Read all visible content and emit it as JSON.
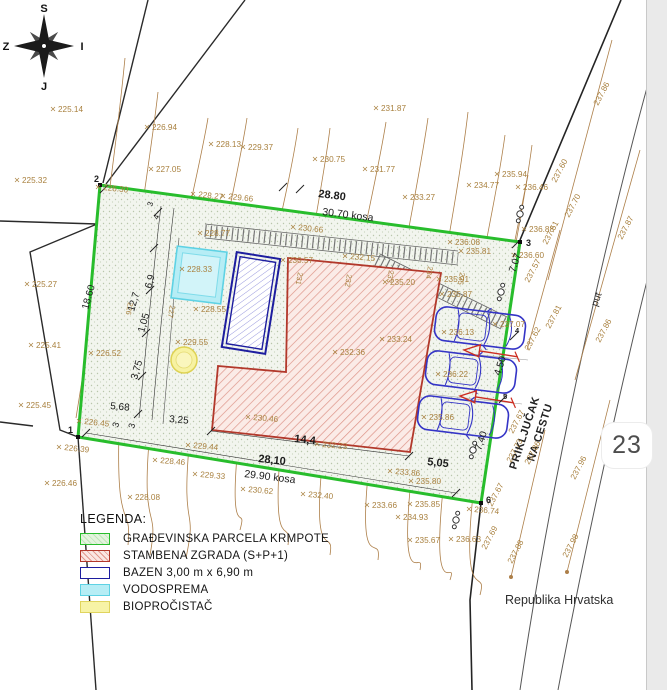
{
  "badge": "23",
  "compass": {
    "north": "S",
    "south": "J",
    "west": "Z",
    "east": "I"
  },
  "texts": {
    "country": "Republika Hrvatska",
    "road": "put",
    "connection1": "PRIKLJUČAK",
    "connection2": "NA CESTU"
  },
  "legend": {
    "title": "LEGENDA:",
    "items": [
      {
        "key": "parcel",
        "label": "GRAĐEVINSKA PARCELA KRMPOTE"
      },
      {
        "key": "building",
        "label": "STAMBENA ZGRADA (S+P+1)"
      },
      {
        "key": "pool",
        "label": "BAZEN 3,00 m x 6,90 m"
      },
      {
        "key": "cistern",
        "label": "VODOSPREMA"
      },
      {
        "key": "bio",
        "label": "BIOPROČISTAČ"
      }
    ]
  },
  "labels": {
    "elevation": [
      {
        "t": "225.14",
        "x": 58,
        "y": 112
      },
      {
        "t": "225.32",
        "x": 22,
        "y": 183
      },
      {
        "t": "225.27",
        "x": 32,
        "y": 287
      },
      {
        "t": "225.41",
        "x": 36,
        "y": 348
      },
      {
        "t": "225.45",
        "x": 26,
        "y": 408
      },
      {
        "t": "226.46",
        "x": 52,
        "y": 486
      },
      {
        "t": "226.39",
        "x": 64,
        "y": 450,
        "r": 6
      },
      {
        "t": "226.30",
        "x": 103,
        "y": 190,
        "r": 6
      },
      {
        "t": "226.52",
        "x": 96,
        "y": 356
      },
      {
        "t": "226.45",
        "x": 84,
        "y": 424,
        "r": 6
      },
      {
        "t": "226.94",
        "x": 152,
        "y": 130
      },
      {
        "t": "227.05",
        "x": 156,
        "y": 172
      },
      {
        "t": "228.13",
        "x": 216,
        "y": 147
      },
      {
        "t": "229.37",
        "x": 248,
        "y": 150
      },
      {
        "t": "230.75",
        "x": 320,
        "y": 162
      },
      {
        "t": "231.87",
        "x": 381,
        "y": 111
      },
      {
        "t": "231.77",
        "x": 370,
        "y": 172
      },
      {
        "t": "233.27",
        "x": 410,
        "y": 200
      },
      {
        "t": "234.77",
        "x": 474,
        "y": 188
      },
      {
        "t": "235.94",
        "x": 502,
        "y": 177
      },
      {
        "t": "236.46",
        "x": 523,
        "y": 190
      },
      {
        "t": "236.88",
        "x": 529,
        "y": 232
      },
      {
        "t": "236.60",
        "x": 519,
        "y": 258
      },
      {
        "t": "236.08",
        "x": 455,
        "y": 245
      },
      {
        "t": "235.81",
        "x": 466,
        "y": 254
      },
      {
        "t": "235.91",
        "x": 444,
        "y": 282
      },
      {
        "t": "235.87",
        "x": 447,
        "y": 297
      },
      {
        "t": "228.27",
        "x": 198,
        "y": 197,
        "r": 6
      },
      {
        "t": "229.66",
        "x": 228,
        "y": 199,
        "r": 6
      },
      {
        "t": "228.77",
        "x": 205,
        "y": 236
      },
      {
        "t": "230.66",
        "x": 298,
        "y": 230,
        "r": 6
      },
      {
        "t": "232.15",
        "x": 350,
        "y": 259,
        "r": 5
      },
      {
        "t": "230.57",
        "x": 288,
        "y": 263
      },
      {
        "t": "228.33",
        "x": 187,
        "y": 272
      },
      {
        "t": "228.55",
        "x": 201,
        "y": 312
      },
      {
        "t": "229.55",
        "x": 183,
        "y": 345
      },
      {
        "t": "230.46",
        "x": 253,
        "y": 420,
        "r": 5
      },
      {
        "t": "232.23",
        "x": 322,
        "y": 447,
        "r": 5
      },
      {
        "t": "232.36",
        "x": 340,
        "y": 355
      },
      {
        "t": "233.24",
        "x": 387,
        "y": 342
      },
      {
        "t": "235.20",
        "x": 390,
        "y": 285
      },
      {
        "t": "229.44",
        "x": 193,
        "y": 448,
        "r": 5
      },
      {
        "t": "229.33",
        "x": 200,
        "y": 477,
        "r": 5
      },
      {
        "t": "228.46",
        "x": 160,
        "y": 463,
        "r": 5
      },
      {
        "t": "228.08",
        "x": 135,
        "y": 500
      },
      {
        "t": "230.62",
        "x": 248,
        "y": 492,
        "r": 5
      },
      {
        "t": "232.40",
        "x": 308,
        "y": 497,
        "r": 5
      },
      {
        "t": "233.86",
        "x": 395,
        "y": 474,
        "r": 5
      },
      {
        "t": "233.66",
        "x": 372,
        "y": 508
      },
      {
        "t": "235.80",
        "x": 416,
        "y": 484
      },
      {
        "t": "235.85",
        "x": 415,
        "y": 507
      },
      {
        "t": "234.93",
        "x": 403,
        "y": 520
      },
      {
        "t": "235.67",
        "x": 415,
        "y": 543
      },
      {
        "t": "236.63",
        "x": 456,
        "y": 542
      },
      {
        "t": "236.74",
        "x": 474,
        "y": 512,
        "r": 5
      },
      {
        "t": "236.13",
        "x": 449,
        "y": 335
      },
      {
        "t": "236.22",
        "x": 443,
        "y": 377
      },
      {
        "t": "235.86",
        "x": 429,
        "y": 420
      },
      {
        "t": "237.07",
        "x": 500,
        "y": 327
      }
    ],
    "road": [
      {
        "t": "237.86",
        "x": 598,
        "y": 106
      },
      {
        "t": "237.60",
        "x": 556,
        "y": 183
      },
      {
        "t": "237.70",
        "x": 569,
        "y": 218
      },
      {
        "t": "237.51",
        "x": 547,
        "y": 245
      },
      {
        "t": "237.87",
        "x": 622,
        "y": 240
      },
      {
        "t": "237.57",
        "x": 529,
        "y": 283
      },
      {
        "t": "237.81",
        "x": 550,
        "y": 329
      },
      {
        "t": "237.86",
        "x": 600,
        "y": 343
      },
      {
        "t": "237.62",
        "x": 529,
        "y": 351
      },
      {
        "t": "237.67",
        "x": 513,
        "y": 434
      },
      {
        "t": "237.73",
        "x": 511,
        "y": 463
      },
      {
        "t": "237.86",
        "x": 529,
        "y": 465
      },
      {
        "t": "237.96",
        "x": 575,
        "y": 480
      },
      {
        "t": "237.67",
        "x": 492,
        "y": 507
      },
      {
        "t": "237.69",
        "x": 486,
        "y": 550
      },
      {
        "t": "237.88",
        "x": 512,
        "y": 564
      },
      {
        "t": "237.98",
        "x": 567,
        "y": 558
      }
    ],
    "tags": [
      {
        "t": "226",
        "x": 128,
        "y": 302
      },
      {
        "t": "227",
        "x": 170,
        "y": 305
      },
      {
        "t": "231",
        "x": 298,
        "y": 272
      },
      {
        "t": "232",
        "x": 347,
        "y": 274
      },
      {
        "t": "233",
        "x": 389,
        "y": 270
      },
      {
        "t": "234",
        "x": 428,
        "y": 266
      },
      {
        "t": "235",
        "x": 460,
        "y": 272
      }
    ],
    "dims": [
      {
        "t": "28.80",
        "x": 318,
        "y": 197,
        "r": 7,
        "b": 1,
        "s": 11
      },
      {
        "t": "30.70 kosa",
        "x": 322,
        "y": 215,
        "r": 7,
        "s": 10.5
      },
      {
        "t": "18.60",
        "x": 88,
        "y": 310,
        "r": -74
      },
      {
        "t": "12,7",
        "x": 134,
        "y": 312,
        "r": -74
      },
      {
        "t": "6,9",
        "x": 151,
        "y": 289,
        "r": -74
      },
      {
        "t": "1,05",
        "x": 144,
        "y": 333,
        "r": -74
      },
      {
        "t": "3,75",
        "x": 137,
        "y": 380,
        "r": -74
      },
      {
        "t": "5,68",
        "x": 110,
        "y": 409,
        "r": 5
      },
      {
        "t": "3",
        "x": 118,
        "y": 428,
        "r": -74,
        "s": 9
      },
      {
        "t": "3",
        "x": 134,
        "y": 429,
        "r": -74,
        "s": 9
      },
      {
        "t": "3,25",
        "x": 169,
        "y": 422,
        "r": 5
      },
      {
        "t": "3",
        "x": 152,
        "y": 207,
        "r": -70,
        "s": 8
      },
      {
        "t": "4",
        "x": 158,
        "y": 220,
        "r": -70,
        "s": 8
      },
      {
        "t": "14,4",
        "x": 294,
        "y": 442,
        "r": 6,
        "b": 1,
        "s": 11
      },
      {
        "t": "28,10",
        "x": 258,
        "y": 462,
        "r": 6,
        "b": 1,
        "s": 11
      },
      {
        "t": "29.90 kosa",
        "x": 244,
        "y": 477,
        "r": 7,
        "s": 10.5
      },
      {
        "t": "5,05",
        "x": 427,
        "y": 465,
        "r": 6,
        "b": 1,
        "s": 11
      },
      {
        "t": "7.07",
        "x": 515,
        "y": 273,
        "r": -72
      },
      {
        "t": "4.50",
        "x": 500,
        "y": 376,
        "r": -72
      },
      {
        "t": "7,40",
        "x": 481,
        "y": 451,
        "r": -72
      }
    ],
    "points": [
      {
        "t": "1",
        "x": 68,
        "y": 433
      },
      {
        "t": "2",
        "x": 94,
        "y": 182
      },
      {
        "t": "3",
        "x": 526,
        "y": 246
      },
      {
        "t": "4",
        "x": 515,
        "y": 333,
        "s": 7.5
      },
      {
        "t": "5",
        "x": 503,
        "y": 399,
        "s": 7.5
      },
      {
        "t": "6",
        "x": 486,
        "y": 503
      }
    ]
  },
  "colors": {
    "parcel_green": "#28bd2c",
    "building_red": "#b2382b",
    "building_hatch": "#dd9488",
    "pool_blue": "#1d1d9f",
    "cistern_cyan": "#5ed2e4",
    "bio_yellow": "#e0d45e",
    "contour_brown": "#ad7f49",
    "label_brown": "#a9813f",
    "ink": "#1c1c1c",
    "road_gray": "#4a4a4a",
    "car_blue": "#3434c6",
    "arrow_red": "#cc2d21"
  }
}
